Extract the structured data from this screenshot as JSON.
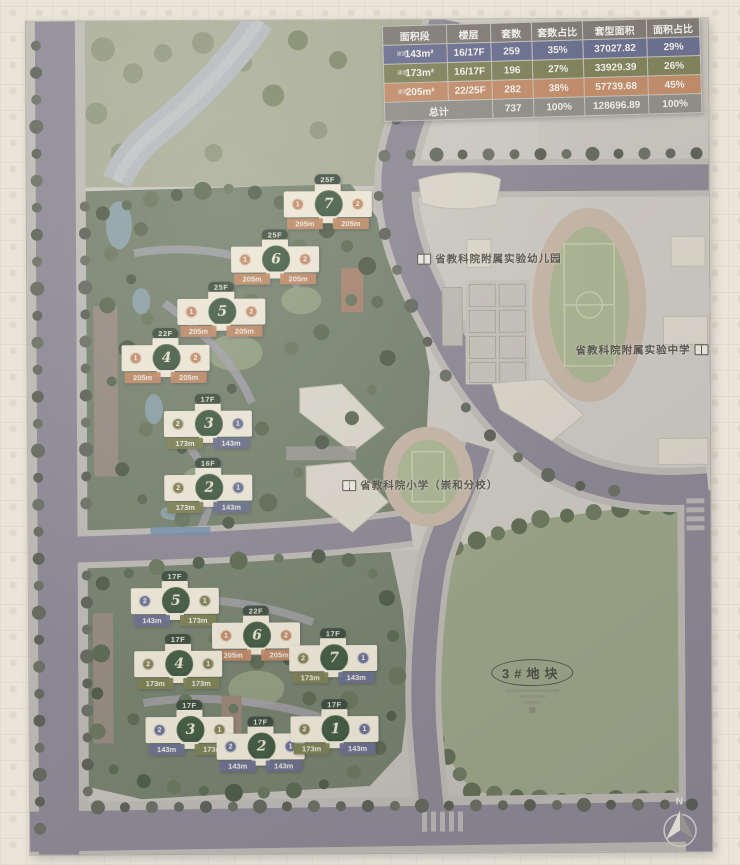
{
  "table": {
    "headers": [
      "面积段",
      "楼层",
      "套数",
      "套数占比",
      "套型面积",
      "面积占比"
    ],
    "rows": [
      {
        "prefix": "建面",
        "segment": "143m²",
        "floors": "16/17F",
        "count": "259",
        "count_pct": "35%",
        "gfa": "37027.82",
        "gfa_pct": "29%",
        "color": "#666b8c"
      },
      {
        "prefix": "建面",
        "segment": "173m²",
        "floors": "16/17F",
        "count": "196",
        "count_pct": "27%",
        "gfa": "33929.39",
        "gfa_pct": "26%",
        "color": "#7d7f55"
      },
      {
        "prefix": "建面",
        "segment": "205m²",
        "floors": "22/25F",
        "count": "282",
        "count_pct": "38%",
        "gfa": "57739.68",
        "gfa_pct": "45%",
        "color": "#c18a64"
      }
    ],
    "total": {
      "label": "总计",
      "count": "737",
      "count_pct": "100%",
      "gfa": "128696.89",
      "gfa_pct": "100%"
    }
  },
  "labels": {
    "kindergarten": "省教科院附属实验幼儿园",
    "middle_school": "省教科院附属实验中学",
    "primary_school": "省教科院小学（崇和分校）",
    "plot": "3#地块",
    "north": "N"
  },
  "buildings": {
    "upper": [
      {
        "no": "7",
        "floors": "25F",
        "left_unit": "1",
        "left_area": "205m",
        "left_type": "205",
        "right_unit": "2",
        "right_area": "205m",
        "right_type": "205"
      },
      {
        "no": "6",
        "floors": "25F",
        "left_unit": "1",
        "left_area": "205m",
        "left_type": "205",
        "right_unit": "2",
        "right_area": "205m",
        "right_type": "205"
      },
      {
        "no": "5",
        "floors": "25F",
        "left_unit": "1",
        "left_area": "205m",
        "left_type": "205",
        "right_unit": "2",
        "right_area": "205m",
        "right_type": "205"
      },
      {
        "no": "4",
        "floors": "22F",
        "left_unit": "1",
        "left_area": "205m",
        "left_type": "205",
        "right_unit": "2",
        "right_area": "205m",
        "right_type": "205"
      },
      {
        "no": "3",
        "floors": "17F",
        "left_unit": "2",
        "left_area": "173m",
        "left_type": "173",
        "right_unit": "1",
        "right_area": "143m",
        "right_type": "143"
      },
      {
        "no": "2",
        "floors": "16F",
        "left_unit": "2",
        "left_area": "173m",
        "left_type": "173",
        "right_unit": "1",
        "right_area": "143m",
        "right_type": "143"
      }
    ],
    "lower": [
      {
        "no": "5",
        "floors": "17F",
        "left_unit": "2",
        "left_area": "143m",
        "left_type": "143",
        "right_unit": "1",
        "right_area": "173m",
        "right_type": "173"
      },
      {
        "no": "6",
        "floors": "22F",
        "left_unit": "1",
        "left_area": "205m",
        "left_type": "205",
        "right_unit": "2",
        "right_area": "205m",
        "right_type": "205"
      },
      {
        "no": "4",
        "floors": "17F",
        "left_unit": "2",
        "left_area": "173m",
        "left_type": "173",
        "right_unit": "1",
        "right_area": "173m",
        "right_type": "173"
      },
      {
        "no": "7",
        "floors": "17F",
        "left_unit": "2",
        "left_area": "173m",
        "left_type": "173",
        "right_unit": "1",
        "right_area": "143m",
        "right_type": "143"
      },
      {
        "no": "3",
        "floors": "17F",
        "left_unit": "2",
        "left_area": "143m",
        "left_type": "143",
        "right_unit": "1",
        "right_area": "173m",
        "right_type": "173"
      },
      {
        "no": "2",
        "floors": "17F",
        "left_unit": "2",
        "left_area": "143m",
        "left_type": "143",
        "right_unit": "1",
        "right_area": "143m",
        "right_type": "143"
      },
      {
        "no": "1",
        "floors": "17F",
        "left_unit": "2",
        "left_area": "173m",
        "left_type": "173",
        "right_unit": "1",
        "right_area": "143m",
        "right_type": "143"
      }
    ]
  },
  "colors": {
    "type_143": "#6a6f8e",
    "type_173": "#7e8050",
    "type_205": "#c28a63",
    "road": "#8b8793",
    "parcel_green": "#73806a",
    "plot_green": "#9ba586"
  }
}
